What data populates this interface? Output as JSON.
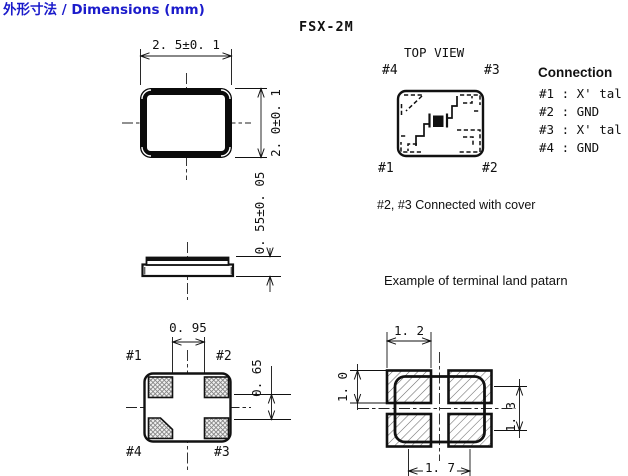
{
  "page": {
    "title": "外形寸法 / Dimensions (mm)",
    "model": "FSX-2M"
  },
  "colors": {
    "title_blue": "#1b1bcb",
    "line": "#111111"
  },
  "top_view": {
    "label": "TOP VIEW",
    "pin_tl": "#4",
    "pin_tr": "#3",
    "pin_bl": "#1",
    "pin_br": "#2"
  },
  "connection": {
    "heading": "Connection",
    "rows": [
      "#1 : X' tal",
      "#2 : GND",
      "#3 : X' tal",
      "#4 : GND"
    ],
    "note": "#2, #3 Connected with cover"
  },
  "outline": {
    "width": "2. 5±0. 1",
    "height": "2. 0±0. 1",
    "thickness": "0. 55±0. 05"
  },
  "bottom_view": {
    "pin_tl": "#1",
    "pin_tr": "#2",
    "pin_bl": "#4",
    "pin_br": "#3",
    "pad_gap_x": "0. 95",
    "pad_dim_y": "0. 65"
  },
  "land_pattern": {
    "heading": "Example of terminal land  patarn",
    "pad_w": "1. 2",
    "pad_h": "1. 0",
    "pitch_y": "1. 3",
    "pitch_x": "1. 7"
  }
}
